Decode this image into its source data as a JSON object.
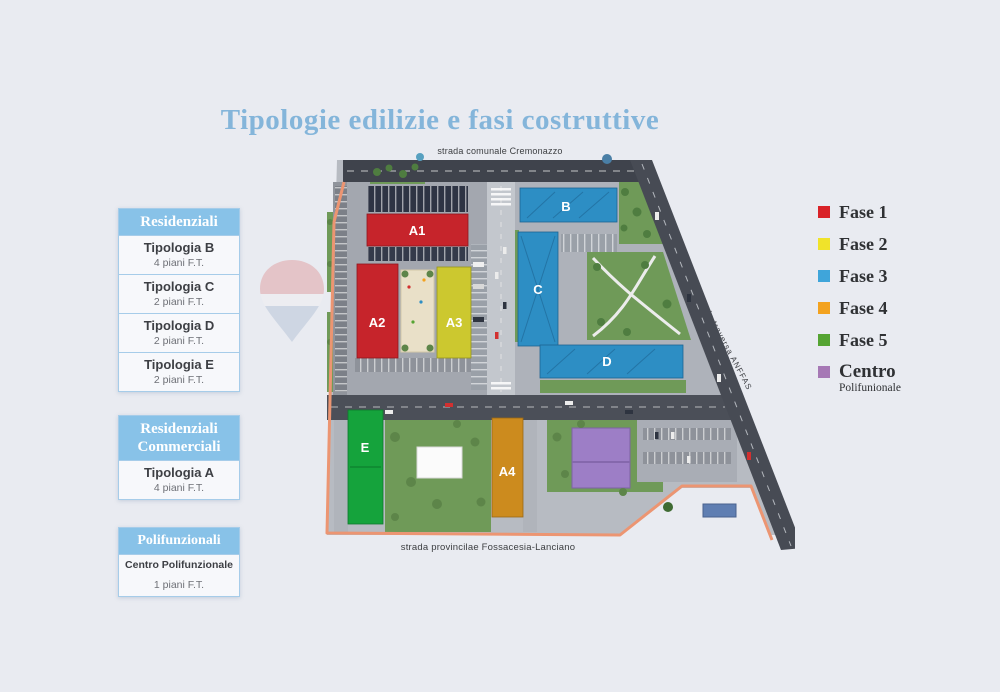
{
  "title": "Tipologie edilizie e fasi costruttive",
  "roads": {
    "top": "strada comunale Cremonazzo",
    "bottom": "strada provincilae Fossacesia-Lanciano",
    "right": "strada traversa ANFFAS"
  },
  "sidebar": {
    "groups": [
      {
        "header": "Residenziali",
        "items": [
          {
            "name": "Tipologia B",
            "floors": "4 piani F.T."
          },
          {
            "name": "Tipologia C",
            "floors": "2 piani F.T."
          },
          {
            "name": "Tipologia D",
            "floors": "2 piani F.T."
          },
          {
            "name": "Tipologia E",
            "floors": "2 piani F.T."
          }
        ]
      },
      {
        "header": "Residenziali Commerciali",
        "items": [
          {
            "name": "Tipologia A",
            "floors": "4 piani F.T."
          }
        ]
      },
      {
        "header": "Polifunzionali",
        "items": [
          {
            "name": "Centro Polifunzionale",
            "floors": "1 piani F.T."
          }
        ]
      }
    ]
  },
  "legend": {
    "items": [
      {
        "label": "Fase 1",
        "color": "#d92228"
      },
      {
        "label": "Fase 2",
        "color": "#f0e32a"
      },
      {
        "label": "Fase 3",
        "color": "#3fa5da"
      },
      {
        "label": "Fase 4",
        "color": "#f3a21f"
      },
      {
        "label": "Fase 5",
        "color": "#55a433"
      },
      {
        "label": "Centro",
        "sub": "Polifunionale",
        "color": "#a678b5"
      }
    ]
  },
  "map": {
    "buildings": [
      {
        "id": "A1",
        "color": "#c6242b"
      },
      {
        "id": "A2",
        "color": "#c6242b"
      },
      {
        "id": "A3",
        "color": "#ccc82f"
      },
      {
        "id": "B",
        "color": "#2d8ec4"
      },
      {
        "id": "C",
        "color": "#2d8ec4"
      },
      {
        "id": "D",
        "color": "#2d8ec4"
      },
      {
        "id": "E",
        "color": "#15a33c"
      },
      {
        "id": "A4",
        "color": "#cc8b1e"
      }
    ]
  }
}
